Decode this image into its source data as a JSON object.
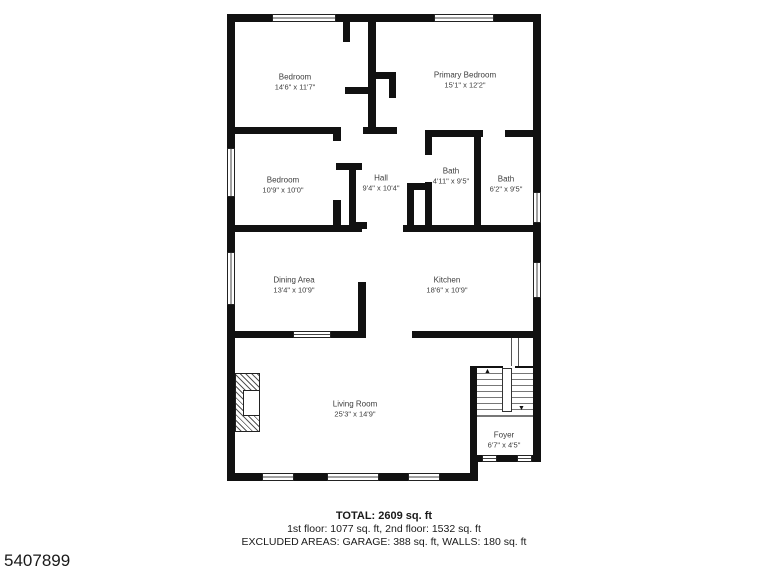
{
  "colors": {
    "wall": "#111111",
    "label_text": "#3d3d3d",
    "footer_text": "#1a1a1a",
    "background": "#ffffff"
  },
  "rooms": {
    "bedroom_top": {
      "name": "Bedroom",
      "dims": "14'6\" x 11'7\""
    },
    "primary_bedroom": {
      "name": "Primary Bedroom",
      "dims": "15'1\" x 12'2\""
    },
    "bedroom_mid": {
      "name": "Bedroom",
      "dims": "10'9\" x 10'0\""
    },
    "hall": {
      "name": "Hall",
      "dims": "9'4\" x 10'4\""
    },
    "bath_1": {
      "name": "Bath",
      "dims": "4'11\" x 9'5\""
    },
    "bath_2": {
      "name": "Bath",
      "dims": "6'2\" x 9'5\""
    },
    "dining": {
      "name": "Dining Area",
      "dims": "13'4\" x 10'9\""
    },
    "kitchen": {
      "name": "Kitchen",
      "dims": "18'6\" x 10'9\""
    },
    "living": {
      "name": "Living Room",
      "dims": "25'3\" x 14'9\""
    },
    "foyer": {
      "name": "Foyer",
      "dims": "6'7\" x 4'5\""
    }
  },
  "icons": {
    "stairs_up_arrow": "▲",
    "stairs_down_arrow": "▼"
  },
  "footer": {
    "total": "TOTAL: 2609 sq. ft",
    "floors": "1st floor: 1077 sq. ft, 2nd floor: 1532 sq. ft",
    "excluded": "EXCLUDED AREAS: GARAGE: 388 sq. ft, WALLS: 180 sq. ft"
  },
  "watermark_id": "5407899"
}
